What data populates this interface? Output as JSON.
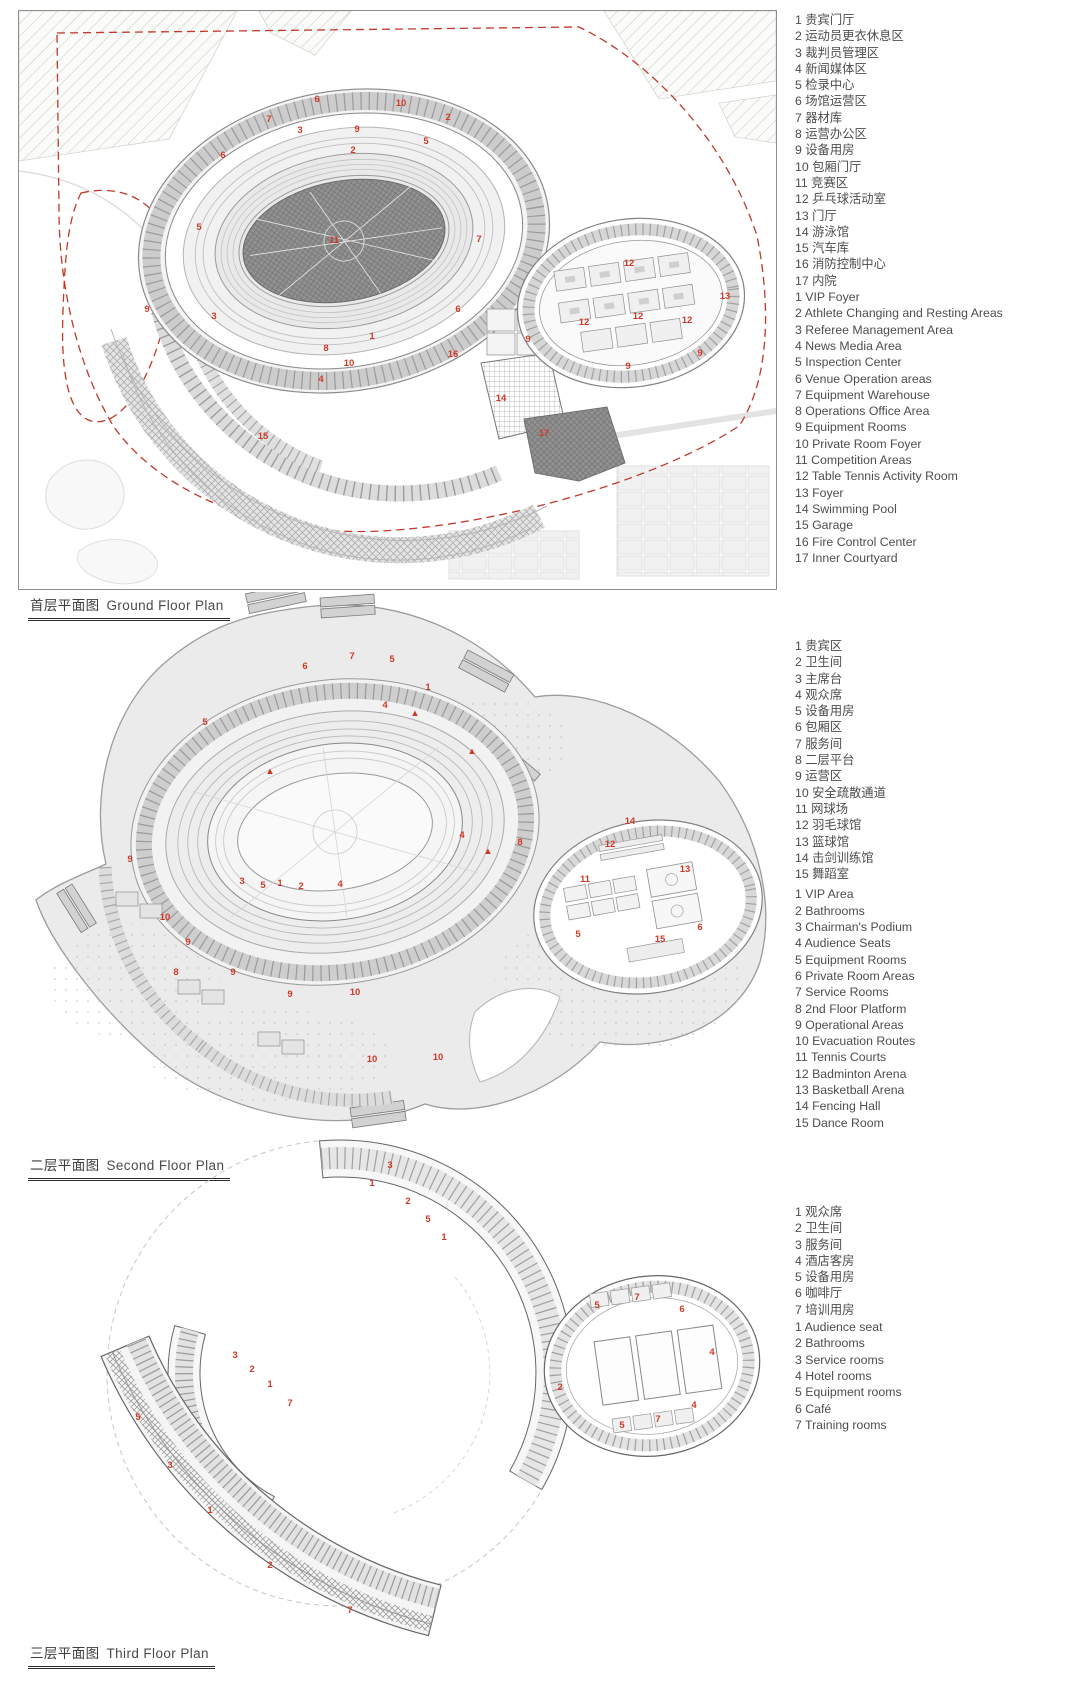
{
  "colors": {
    "marker_red": "#cf3a28",
    "boundary_red_dash": "#c0392b",
    "line_dark": "#666666",
    "line_mid": "#9a9a9a",
    "line_light": "#d9d9d9"
  },
  "plans": [
    {
      "title_zh": "首层平面图",
      "title_en": "Ground Floor Plan",
      "legend_zh": [
        "1 贵宾门厅",
        "2 运动员更衣休息区",
        "3 裁判员管理区",
        "4 新闻媒体区",
        "5 检录中心",
        "6 场馆运营区",
        "7 器材库",
        "8 运营办公区",
        "9 设备用房",
        "10 包厢门厅",
        "11 竞赛区",
        "12 乒乓球活动室",
        "13 门厅",
        "14 游泳馆",
        "15 汽车库",
        "16 消防控制中心",
        "17 内院"
      ],
      "legend_en": [
        "1 VIP Foyer",
        "2 Athlete Changing and Resting Areas",
        "3 Referee Management Area",
        "4 News Media Area",
        "5 Inspection Center",
        "6 Venue Operation areas",
        "7 Equipment Warehouse",
        "8 Operations Office Area",
        "9 Equipment Rooms",
        "10 Private Room Foyer",
        "11 Competition Areas",
        "12 Table Tennis Activity Room",
        "13 Foyer",
        "14 Swimming Pool",
        "15 Garage",
        "16 Fire Control Center",
        "17 Inner Courtyard"
      ],
      "markers": [
        {
          "n": "6",
          "x": 298,
          "y": 91
        },
        {
          "n": "10",
          "x": 382,
          "y": 95
        },
        {
          "n": "2",
          "x": 429,
          "y": 109
        },
        {
          "n": "7",
          "x": 250,
          "y": 111
        },
        {
          "n": "3",
          "x": 281,
          "y": 122
        },
        {
          "n": "9",
          "x": 338,
          "y": 121
        },
        {
          "n": "5",
          "x": 407,
          "y": 133
        },
        {
          "n": "6",
          "x": 204,
          "y": 147
        },
        {
          "n": "2",
          "x": 334,
          "y": 142
        },
        {
          "n": "5",
          "x": 180,
          "y": 219
        },
        {
          "n": "11",
          "x": 315,
          "y": 232
        },
        {
          "n": "7",
          "x": 460,
          "y": 231
        },
        {
          "n": "6",
          "x": 439,
          "y": 301
        },
        {
          "n": "3",
          "x": 195,
          "y": 308
        },
        {
          "n": "9",
          "x": 128,
          "y": 301
        },
        {
          "n": "8",
          "x": 307,
          "y": 340
        },
        {
          "n": "1",
          "x": 353,
          "y": 328
        },
        {
          "n": "16",
          "x": 434,
          "y": 346
        },
        {
          "n": "4",
          "x": 302,
          "y": 371
        },
        {
          "n": "10",
          "x": 330,
          "y": 355
        },
        {
          "n": "15",
          "x": 244,
          "y": 428
        },
        {
          "n": "14",
          "x": 482,
          "y": 390
        },
        {
          "n": "17",
          "x": 525,
          "y": 425
        },
        {
          "n": "9",
          "x": 509,
          "y": 331
        },
        {
          "n": "12",
          "x": 610,
          "y": 255
        },
        {
          "n": "12",
          "x": 565,
          "y": 314
        },
        {
          "n": "12",
          "x": 619,
          "y": 308
        },
        {
          "n": "12",
          "x": 668,
          "y": 312
        },
        {
          "n": "13",
          "x": 706,
          "y": 288
        },
        {
          "n": "9",
          "x": 681,
          "y": 345
        },
        {
          "n": "9",
          "x": 609,
          "y": 358
        }
      ]
    },
    {
      "title_zh": "二层平面图",
      "title_en": "Second Floor Plan",
      "legend_zh": [
        "1 贵宾区",
        "2 卫生间",
        "3 主席台",
        "4 观众席",
        "5 设备用房",
        "6 包厢区",
        "7 服务间",
        "8 二层平台",
        "9 运营区",
        "10 安全疏散通道",
        "11 网球场",
        "12 羽毛球馆",
        "13 篮球馆",
        "14 击剑训练馆",
        "15 舞蹈室"
      ],
      "legend_en": [
        "1 VIP Area",
        "2 Bathrooms",
        "3 Chairman's Podium",
        "4 Audience Seats",
        "5 Equipment Rooms",
        "6 Private Room Areas",
        "7 Service Rooms",
        "8 2nd Floor Platform",
        "9 Operational Areas",
        "10 Evacuation Routes",
        "11 Tennis Courts",
        "12 Badminton Arena",
        "13 Basketball Arena",
        "14 Fencing  Hall",
        "15 Dance Room"
      ],
      "markers": [
        {
          "n": "7",
          "x": 332,
          "y": 67
        },
        {
          "n": "5",
          "x": 372,
          "y": 70
        },
        {
          "n": "6",
          "x": 285,
          "y": 77
        },
        {
          "n": "1",
          "x": 408,
          "y": 98
        },
        {
          "n": "4",
          "x": 365,
          "y": 116
        },
        {
          "n": "5",
          "x": 185,
          "y": 133
        },
        {
          "n": "▲",
          "x": 395,
          "y": 124
        },
        {
          "n": "▲",
          "x": 452,
          "y": 162
        },
        {
          "n": "▲",
          "x": 250,
          "y": 182
        },
        {
          "n": "▲",
          "x": 468,
          "y": 262
        },
        {
          "n": "4",
          "x": 442,
          "y": 246
        },
        {
          "n": "9",
          "x": 110,
          "y": 270
        },
        {
          "n": "10",
          "x": 145,
          "y": 328
        },
        {
          "n": "3",
          "x": 222,
          "y": 292
        },
        {
          "n": "5",
          "x": 243,
          "y": 296
        },
        {
          "n": "1",
          "x": 260,
          "y": 294
        },
        {
          "n": "2",
          "x": 281,
          "y": 297
        },
        {
          "n": "4",
          "x": 320,
          "y": 295
        },
        {
          "n": "8",
          "x": 156,
          "y": 383
        },
        {
          "n": "9",
          "x": 168,
          "y": 353
        },
        {
          "n": "9",
          "x": 213,
          "y": 383
        },
        {
          "n": "9",
          "x": 270,
          "y": 405
        },
        {
          "n": "10",
          "x": 335,
          "y": 403
        },
        {
          "n": "8",
          "x": 500,
          "y": 253
        },
        {
          "n": "14",
          "x": 610,
          "y": 232
        },
        {
          "n": "12",
          "x": 590,
          "y": 255
        },
        {
          "n": "11",
          "x": 565,
          "y": 290
        },
        {
          "n": "13",
          "x": 665,
          "y": 280
        },
        {
          "n": "15",
          "x": 640,
          "y": 350
        },
        {
          "n": "5",
          "x": 558,
          "y": 345
        },
        {
          "n": "6",
          "x": 680,
          "y": 338
        },
        {
          "n": "10",
          "x": 352,
          "y": 470
        },
        {
          "n": "10",
          "x": 418,
          "y": 468
        }
      ]
    },
    {
      "title_zh": "三层平面图",
      "title_en": "Third Floor Plan",
      "legend_zh": [
        "1 观众席",
        "2 卫生间",
        "3 服务间",
        "4 酒店客房",
        "5 设备用房",
        "6 咖啡厅",
        "7 培训用房"
      ],
      "legend_en": [
        "1 Audience seat",
        "2 Bathrooms",
        "3 Service rooms",
        "4 Hotel rooms",
        "5 Equipment rooms",
        "6 Café",
        "7 Training rooms"
      ],
      "markers": [
        {
          "n": "3",
          "x": 370,
          "y": 40
        },
        {
          "n": "1",
          "x": 352,
          "y": 58
        },
        {
          "n": "2",
          "x": 388,
          "y": 76
        },
        {
          "n": "5",
          "x": 408,
          "y": 94
        },
        {
          "n": "1",
          "x": 424,
          "y": 112
        },
        {
          "n": "3",
          "x": 215,
          "y": 230
        },
        {
          "n": "2",
          "x": 232,
          "y": 244
        },
        {
          "n": "1",
          "x": 250,
          "y": 259
        },
        {
          "n": "7",
          "x": 270,
          "y": 278
        },
        {
          "n": "5",
          "x": 118,
          "y": 292
        },
        {
          "n": "3",
          "x": 150,
          "y": 340
        },
        {
          "n": "1",
          "x": 190,
          "y": 385
        },
        {
          "n": "2",
          "x": 250,
          "y": 440
        },
        {
          "n": "7",
          "x": 330,
          "y": 485
        },
        {
          "n": "5",
          "x": 577,
          "y": 180
        },
        {
          "n": "7",
          "x": 617,
          "y": 172
        },
        {
          "n": "6",
          "x": 662,
          "y": 184
        },
        {
          "n": "4",
          "x": 692,
          "y": 227
        },
        {
          "n": "2",
          "x": 540,
          "y": 262
        },
        {
          "n": "5",
          "x": 602,
          "y": 300
        },
        {
          "n": "7",
          "x": 638,
          "y": 294
        },
        {
          "n": "4",
          "x": 674,
          "y": 280
        }
      ]
    }
  ]
}
